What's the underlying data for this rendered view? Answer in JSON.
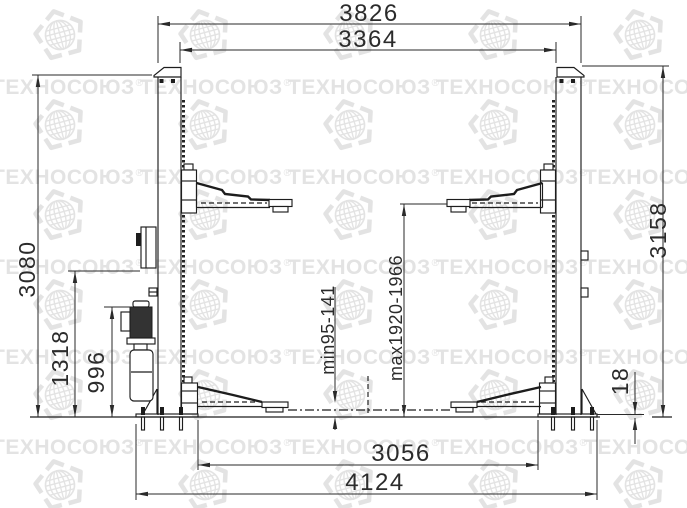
{
  "watermark": {
    "text": "ТЕХНОСОЮЗ",
    "registered": "®"
  },
  "dimensions": {
    "overall_width": "3826",
    "column_inner_span": "3364",
    "column_height_left": "3080",
    "power_unit_height": "1318",
    "pump_height": "996",
    "column_height_right": "3158",
    "base_plate_thickness": "18",
    "pad_min_height": "min95-141",
    "pad_max_height": "max1920-1966",
    "base_inner_span": "3056",
    "base_overall_span": "4124"
  },
  "colors": {
    "line": "#1d1d1d",
    "watermark": "#e3e3e3",
    "background": "#ffffff"
  }
}
